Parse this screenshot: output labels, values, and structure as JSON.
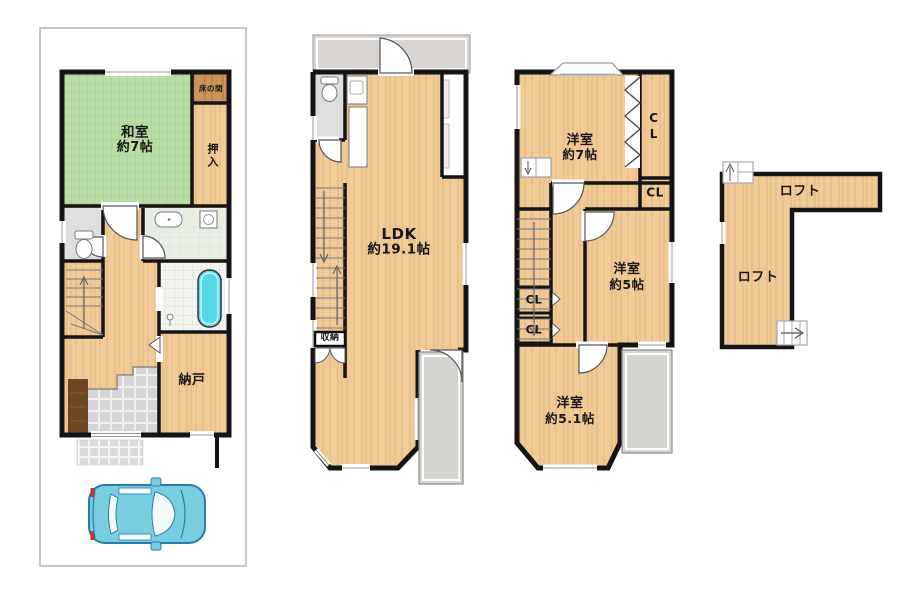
{
  "palette": {
    "wall": "#141414",
    "wood_floor": "#f0ca97",
    "tatami_green": "#b9dda6",
    "tokonoma_wood": "#c9935a",
    "balcony_gray": "#d6d4d1",
    "tile_gray": "#d5d5d5",
    "bathtub_cyan": "#55d9e9",
    "car_blue": "#79cde0"
  },
  "floor1": {
    "washitsu_line1": "和室",
    "washitsu_line2": "約7帖",
    "tokonoma": "床の間",
    "oshiire": "押入",
    "nando": "納戸"
  },
  "floor2": {
    "ldk_line1": "LDK",
    "ldk_line2": "約19.1帖",
    "shuno": "収納"
  },
  "floor3": {
    "yoshitsu7_line1": "洋室",
    "yoshitsu7_line2": "約7帖",
    "closet_right": "CL",
    "closet_mid": "CL",
    "closet_a": "CL",
    "closet_b": "CL",
    "yoshitsu5_line1": "洋室",
    "yoshitsu5_line2": "約5帖",
    "yoshitsu51_line1": "洋室",
    "yoshitsu51_line2": "約5.1帖"
  },
  "loft": {
    "label_upper": "ロフト",
    "label_lower": "ロフト"
  }
}
